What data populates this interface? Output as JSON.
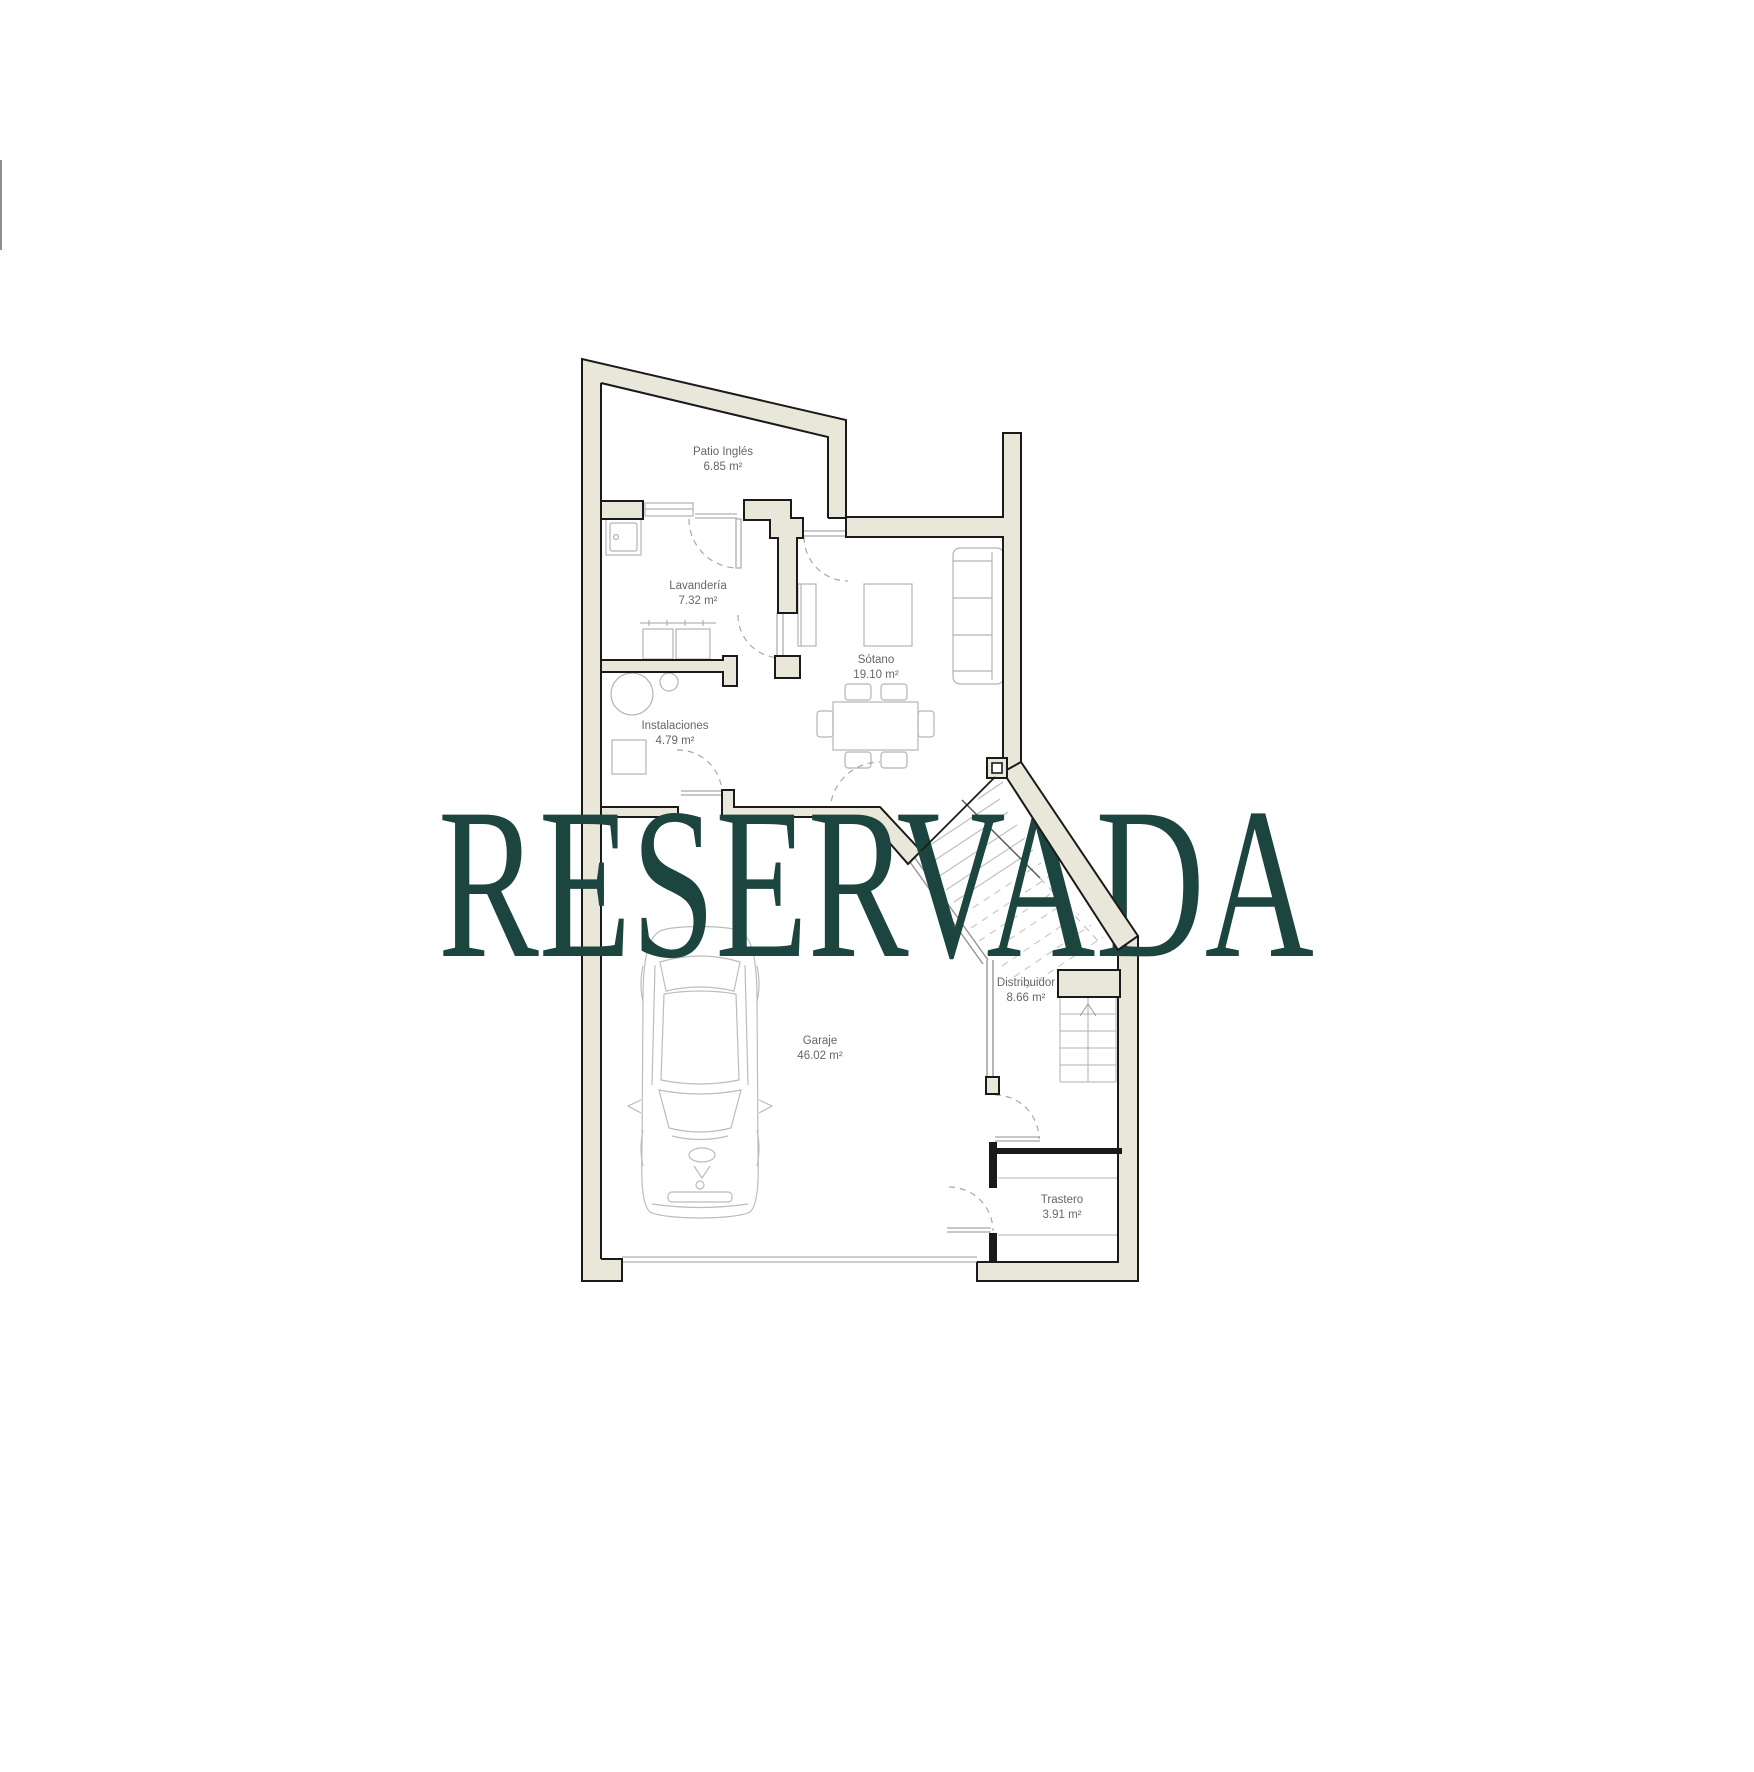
{
  "watermark": {
    "text": "RESERVADA",
    "color": "#1d453f"
  },
  "rooms": [
    {
      "id": "patio-ingles",
      "name": "Patio Inglés",
      "area": "6.85 m²"
    },
    {
      "id": "lavanderia",
      "name": "Lavandería",
      "area": "7.32 m²"
    },
    {
      "id": "sotano",
      "name": "Sótano",
      "area": "19.10 m²"
    },
    {
      "id": "instalaciones",
      "name": "Instalaciones",
      "area": "4.79 m²"
    },
    {
      "id": "distribuidor",
      "name": "Distribuidor",
      "area": "8.66 m²"
    },
    {
      "id": "garaje",
      "name": "Garaje",
      "area": "46.02 m²"
    },
    {
      "id": "trastero",
      "name": "Trastero",
      "area": "3.91 m²"
    }
  ],
  "palette": {
    "background": "#ffffff",
    "wall_fill": "#e9e7d9",
    "wall_line": "#1a1a1a",
    "furniture_line": "#b3b3b3",
    "door_arc_line": "#a8a8a8",
    "label_color": "#666666",
    "watermark_color": "#1d453f"
  },
  "icons": [
    "car-icon",
    "sofa-icon",
    "coffee-table-icon",
    "dining-table-icon",
    "chair-icon",
    "washer-icon",
    "dryer-icon",
    "laundry-sink-icon",
    "boiler-tank-icon",
    "equipment-box-icon",
    "straight-stairs-icon",
    "diagonal-stairs-icon",
    "shelf-icon",
    "door-swing-icon",
    "window-icon",
    "garage-door-icon",
    "column-icon"
  ]
}
